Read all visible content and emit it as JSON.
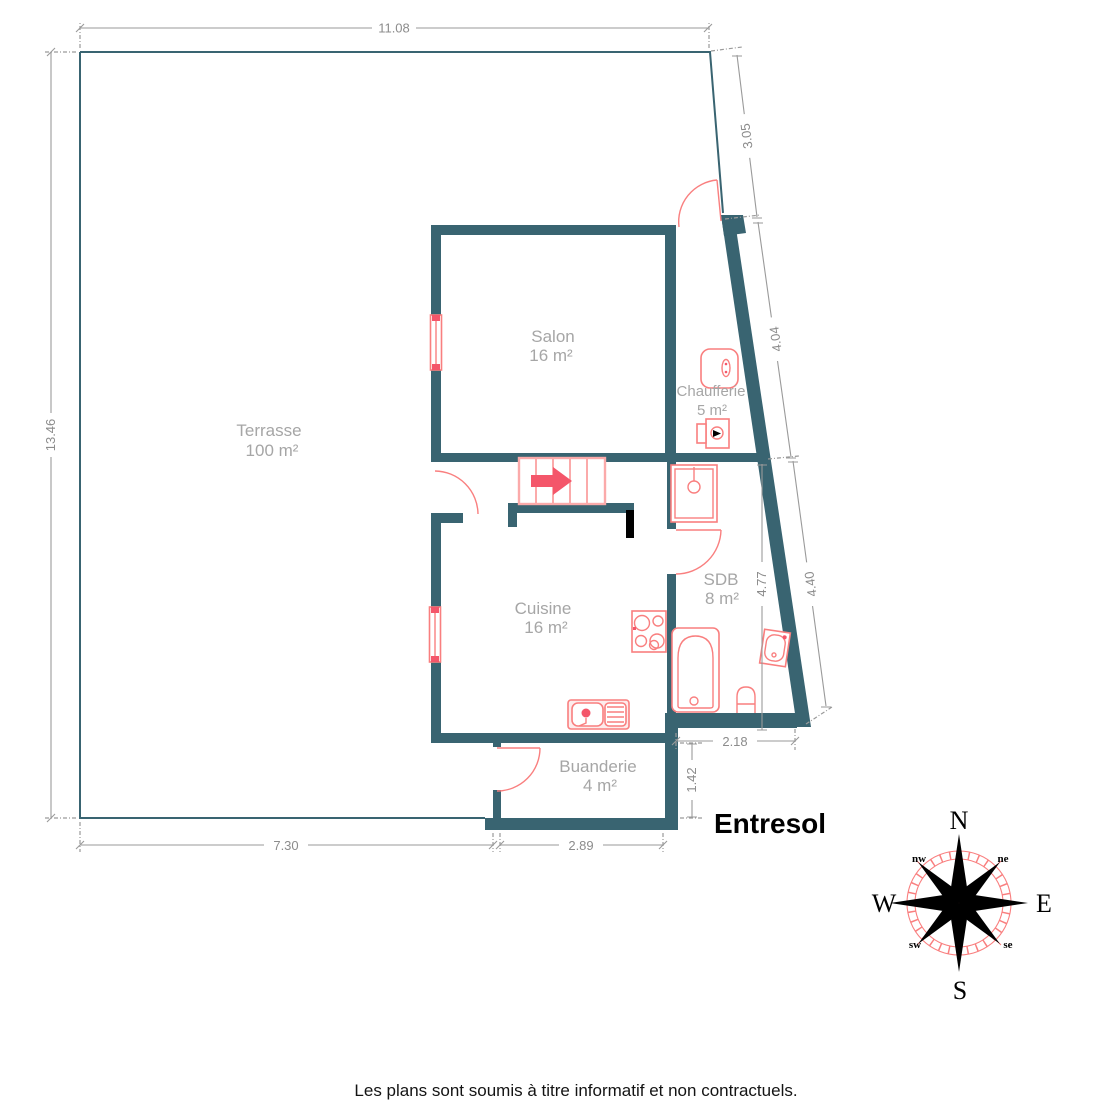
{
  "floorplan": {
    "level_title": "Entresol",
    "disclaimer": "Les plans sont soumis à titre informatif et non contractuels.",
    "rooms": [
      {
        "name": "Terrasse",
        "area": "100 m²"
      },
      {
        "name": "Salon",
        "area": "16 m²"
      },
      {
        "name": "Chaufferie",
        "area": "5 m²"
      },
      {
        "name": "SDB",
        "area": "8 m²"
      },
      {
        "name": "Cuisine",
        "area": "16 m²"
      },
      {
        "name": "Buanderie",
        "area": "4 m²"
      }
    ],
    "dimensions": {
      "top_width": "11.08",
      "left_height": "13.46",
      "right_upper": "3.05",
      "right_mid": "4.04",
      "right_lower": "4.40",
      "sdb_inner_height": "4.77",
      "sdb_bottom_width": "2.18",
      "buanderie_right_height": "1.42",
      "buanderie_bottom_width": "2.89",
      "terrace_bottom_width": "7.30"
    },
    "compass": {
      "north": "N",
      "east": "E",
      "south": "S",
      "west": "W",
      "northwest": "nw",
      "northeast": "ne",
      "southwest": "sw",
      "southeast": "se"
    },
    "colors": {
      "wall": "#396471",
      "fixture": "#f97f7f",
      "accent": "#f4566a",
      "dim": "#9a9a9a",
      "dimtext": "#8c8c8c",
      "label": "#a6a6a6"
    }
  }
}
